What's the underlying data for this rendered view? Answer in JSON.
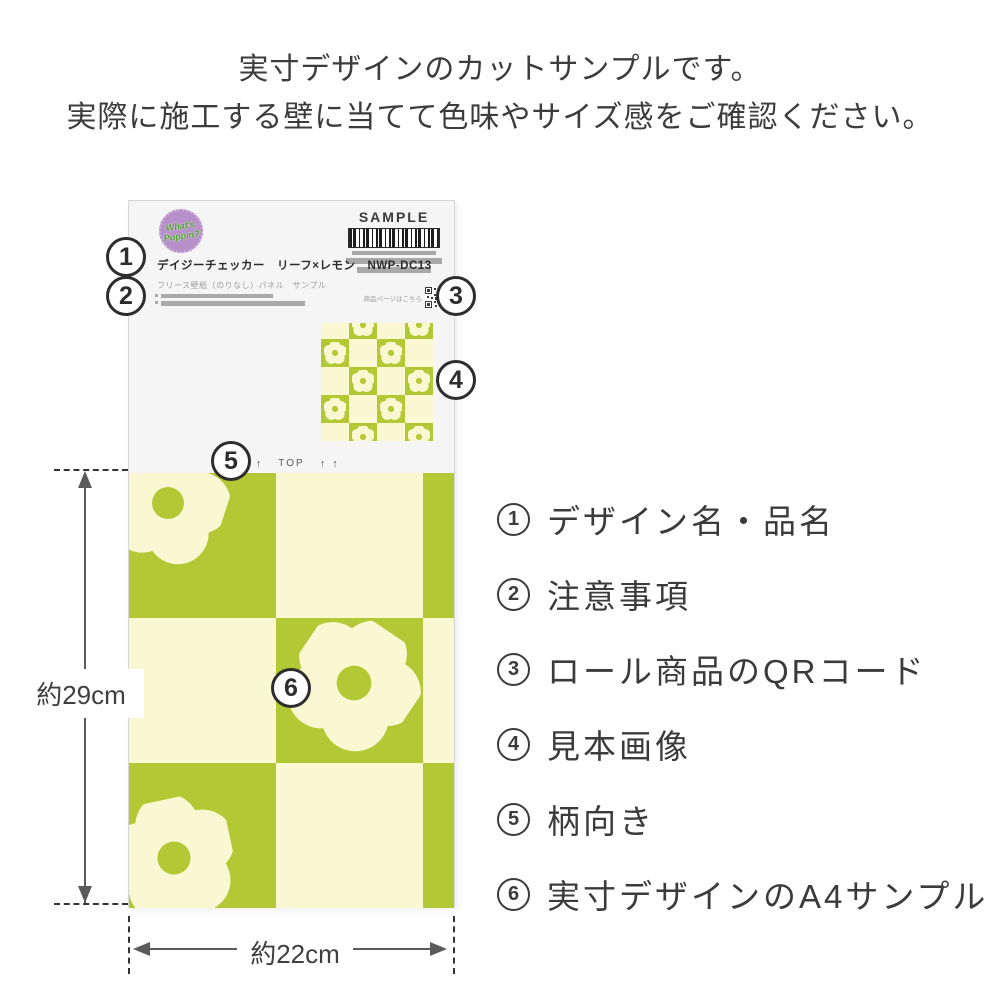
{
  "header": {
    "line1": "実寸デザインのカットサンプルです。",
    "line2": "実際に施工する壁に当てて色味やサイズ感をご確認ください。"
  },
  "card": {
    "logo": {
      "line1": "What's",
      "line2": "Poppin?"
    },
    "sample_label": "SAMPLE",
    "product_title": "デイジーチェッカー　リーフ×レモン　NWP-DC13",
    "product_subtitle": "フリース壁紙（のりなし）パネル　サンプル",
    "qr_caption": "商品ページはこちら",
    "top_mark": {
      "left_arrows": "↑ ↑",
      "label": "TOP",
      "right_arrows": "↑ ↑"
    }
  },
  "callouts": {
    "n1": "1",
    "n2": "2",
    "n3": "3",
    "n4": "4",
    "n5": "5",
    "n6": "6"
  },
  "legend": {
    "items": [
      {
        "num": "1",
        "label": "デザイン名・品名"
      },
      {
        "num": "2",
        "label": "注意事項"
      },
      {
        "num": "3",
        "label": "ロール商品のQRコード"
      },
      {
        "num": "4",
        "label": "見本画像"
      },
      {
        "num": "5",
        "label": "柄向き"
      },
      {
        "num": "6",
        "label": "実寸デザインのA4サンプル"
      }
    ]
  },
  "dimensions": {
    "height_label": "約29cm",
    "width_label": "約22cm"
  },
  "colors": {
    "pattern_green": "#b2c935",
    "pattern_cream": "#f9f8d3",
    "logo_purple": "#b78fc9",
    "logo_text_green": "#4da12c",
    "text_dark": "#3c3c3c"
  }
}
